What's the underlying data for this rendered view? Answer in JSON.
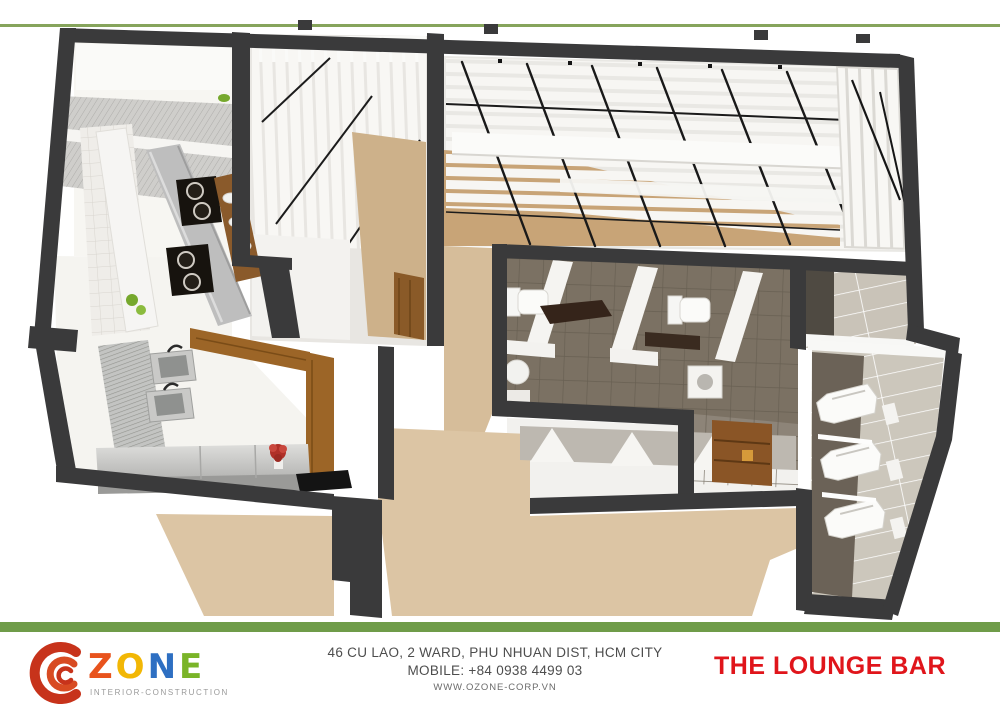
{
  "header": {
    "divider_color": "#86a45c"
  },
  "plan": {
    "type": "3d-floor-plan-rendering",
    "wall_color": "#3a3a3b",
    "floor_beige": "#d9c2a0",
    "toilet_tile": "#7b7163",
    "urinal_tile": "#ccc7bc"
  },
  "footer": {
    "bar_color": "#6f9c49",
    "logo": {
      "swirl_color": "#c7331b",
      "letters": [
        {
          "char": "Z",
          "color": "#e8531d"
        },
        {
          "char": "O",
          "color": "#f2b705"
        },
        {
          "char": "N",
          "color": "#2e6fc2"
        },
        {
          "char": "E",
          "color": "#7ab428"
        }
      ],
      "tagline": "INTERIOR-CONSTRUCTION"
    },
    "address_line1": "46 CU LAO, 2  WARD, PHU NHUAN DIST, HCM CITY",
    "address_line2": "MOBILE: +84 0938 4499 03",
    "website": "WWW.OZONE-CORP.VN",
    "project_title": "THE LOUNGE BAR",
    "title_color": "#e0151b"
  }
}
